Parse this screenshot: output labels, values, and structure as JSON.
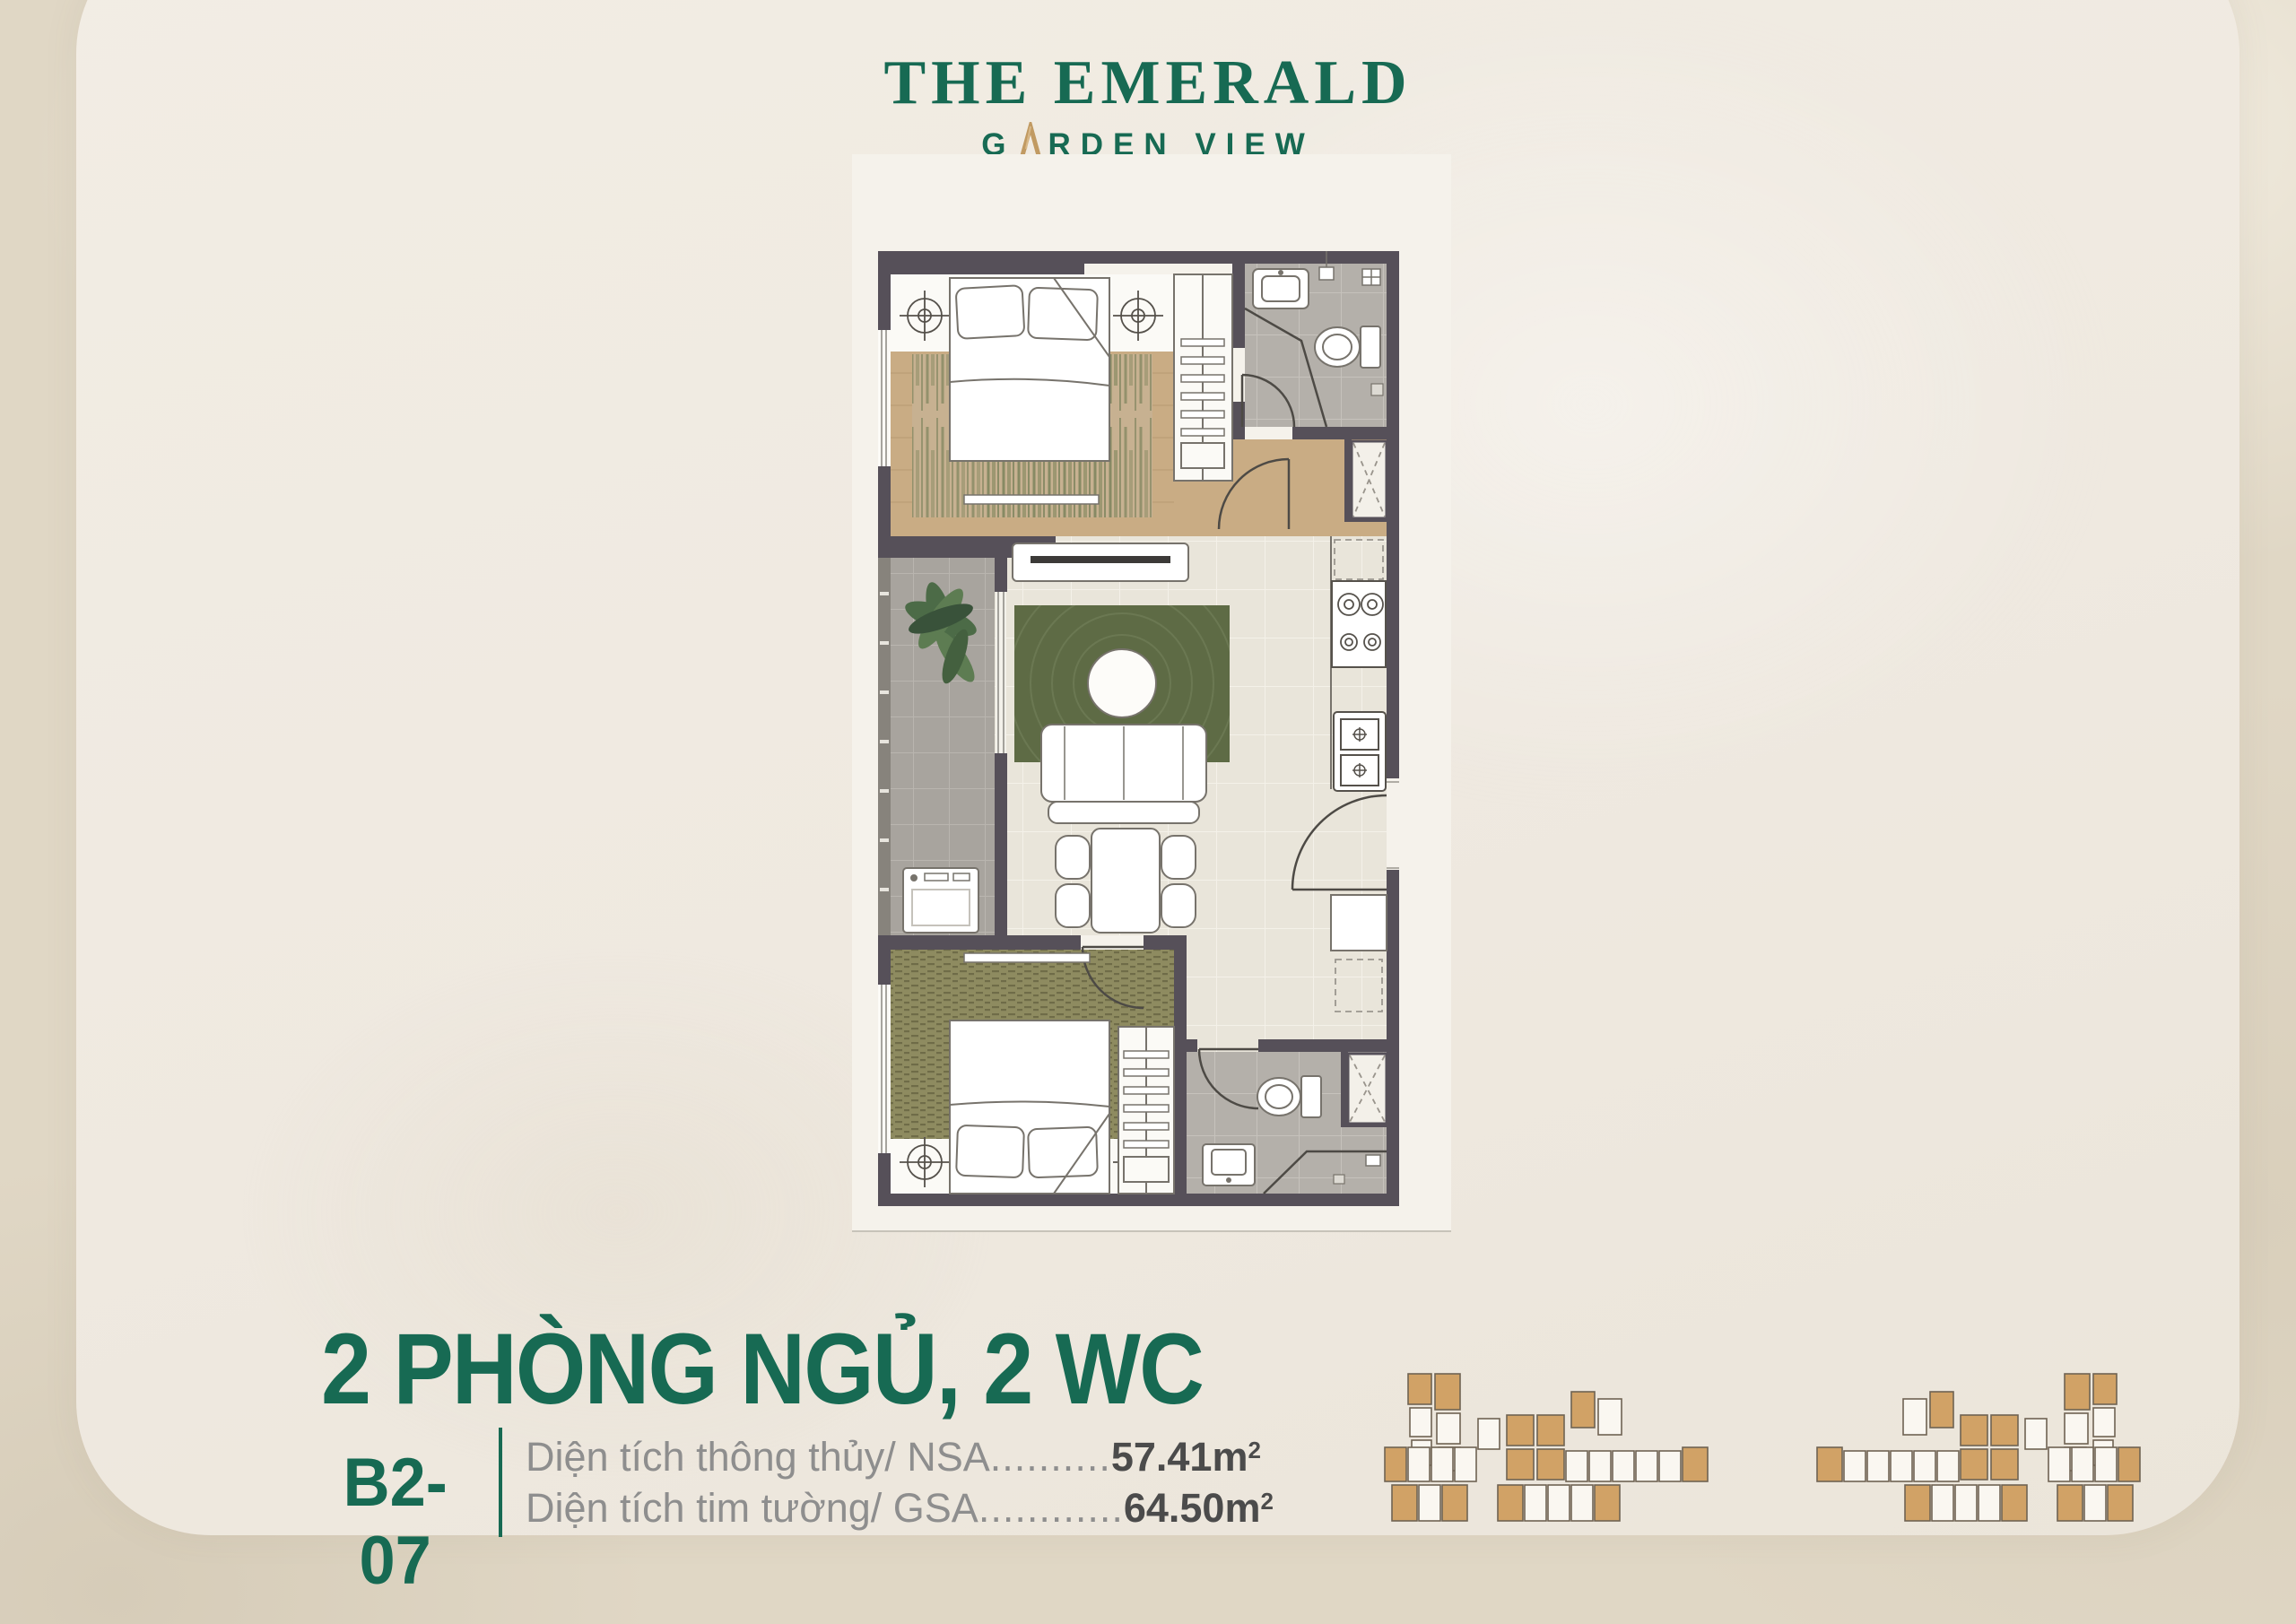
{
  "colors": {
    "brand_green": "#176a53",
    "gold": "#c19a62",
    "wall": "#565059",
    "wood": "#c9ac84",
    "tile_gray": "#b4b0aa",
    "tile_balcony": "#a8a49e",
    "tile_light": "#e9e5da",
    "carpet_olive": "#8e8b60",
    "rug_base": "#c7b191",
    "rug_green": "#5e6b45",
    "keyplan_tan": "#d1a266",
    "keyplan_stroke": "#6f6353",
    "bg_outer": "#e0d7c5",
    "bg_panel": "#efe9e0"
  },
  "logo": {
    "title": "THE EMERALD",
    "subtitle_pre": "G",
    "subtitle_post": "RDEN VIEW",
    "tagline": "Kết Tinh Hoa - Lưu Bản Sắc"
  },
  "unit": {
    "title": "2 PHÒNG NGỦ, 2 WC",
    "code": "B2-07",
    "areas": [
      {
        "label": "Diện tích thông thủy/ NSA",
        "leader": "..........",
        "value": "57.41m",
        "sup": "2"
      },
      {
        "label": "Diện tích tim tường/ GSA",
        "leader": "............",
        "value": "64.50m",
        "sup": "2"
      }
    ]
  }
}
